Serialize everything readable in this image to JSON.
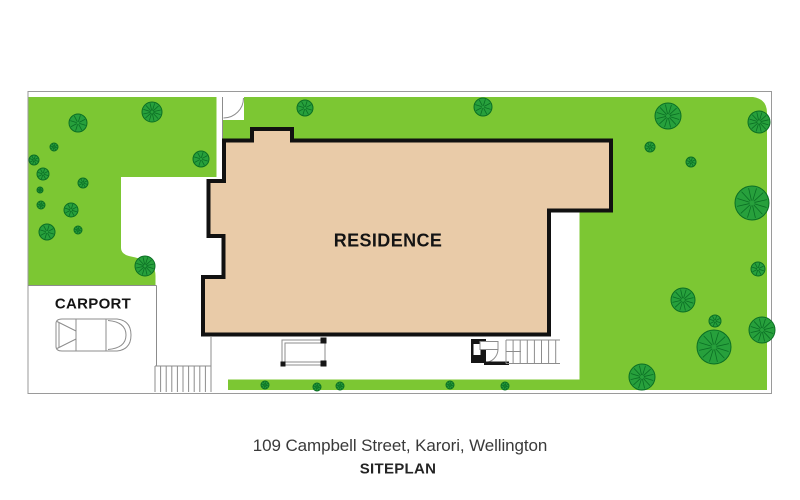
{
  "labels": {
    "residence": "RESIDENCE",
    "carport": "CARPORT"
  },
  "caption": {
    "address": "109 Campbell Street, Karori, Wellington",
    "plan_type": "SITEPLAN"
  },
  "colors": {
    "grass": "#7cc733",
    "tree_fill": "#27a03c",
    "tree_stroke": "#0b6e24",
    "building_fill": "#e9cba8",
    "building_stroke": "#111111",
    "boundary_line": "#9a9a9a",
    "detail_line": "#8c8c8c",
    "black_detail": "#161616"
  },
  "trees": [
    {
      "x": 152,
      "y": 112,
      "r": 10
    },
    {
      "x": 78,
      "y": 123,
      "r": 9
    },
    {
      "x": 54,
      "y": 147,
      "r": 4
    },
    {
      "x": 34,
      "y": 160,
      "r": 5
    },
    {
      "x": 43,
      "y": 174,
      "r": 6
    },
    {
      "x": 83,
      "y": 183,
      "r": 5
    },
    {
      "x": 40,
      "y": 190,
      "r": 3
    },
    {
      "x": 41,
      "y": 205,
      "r": 4
    },
    {
      "x": 71,
      "y": 210,
      "r": 7
    },
    {
      "x": 47,
      "y": 232,
      "r": 8
    },
    {
      "x": 78,
      "y": 230,
      "r": 4
    },
    {
      "x": 201,
      "y": 159,
      "r": 8
    },
    {
      "x": 145,
      "y": 266,
      "r": 10
    },
    {
      "x": 305,
      "y": 108,
      "r": 8
    },
    {
      "x": 483,
      "y": 107,
      "r": 9
    },
    {
      "x": 668,
      "y": 116,
      "r": 13
    },
    {
      "x": 759,
      "y": 122,
      "r": 11
    },
    {
      "x": 650,
      "y": 147,
      "r": 5
    },
    {
      "x": 691,
      "y": 162,
      "r": 5
    },
    {
      "x": 752,
      "y": 203,
      "r": 17
    },
    {
      "x": 758,
      "y": 269,
      "r": 7
    },
    {
      "x": 683,
      "y": 300,
      "r": 12
    },
    {
      "x": 715,
      "y": 321,
      "r": 6
    },
    {
      "x": 714,
      "y": 347,
      "r": 17
    },
    {
      "x": 762,
      "y": 330,
      "r": 13
    },
    {
      "x": 642,
      "y": 377,
      "r": 13
    },
    {
      "x": 265,
      "y": 385,
      "r": 4
    },
    {
      "x": 317,
      "y": 387,
      "r": 4
    },
    {
      "x": 340,
      "y": 386,
      "r": 4
    },
    {
      "x": 450,
      "y": 385,
      "r": 4
    },
    {
      "x": 505,
      "y": 386,
      "r": 4
    }
  ]
}
